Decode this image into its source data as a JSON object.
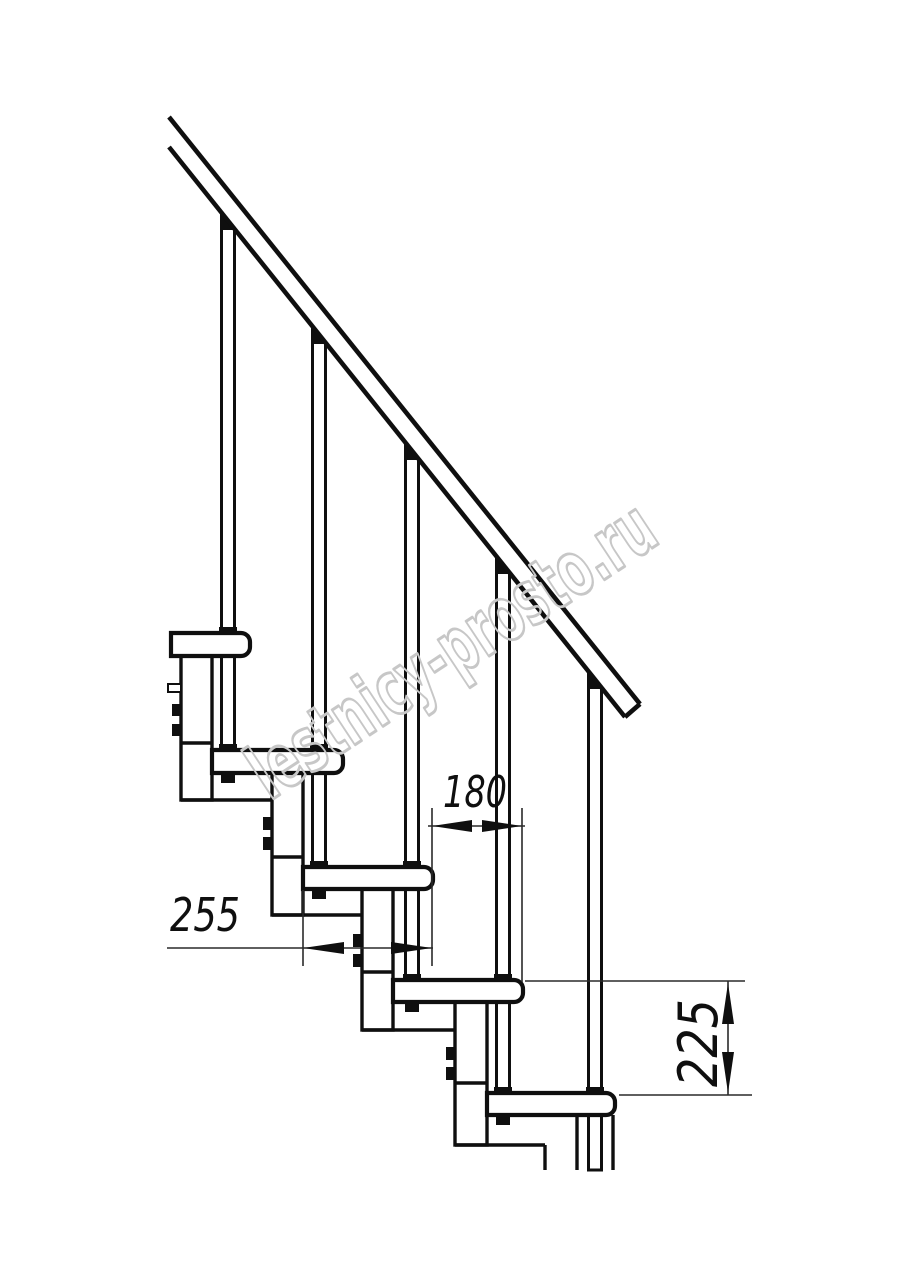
{
  "drawing": {
    "watermark": {
      "text": "lestnicy-prosto.ru",
      "color": "#c7c7c7"
    },
    "dimensions": [
      {
        "id": "step-going",
        "value": "180",
        "orientation": "horizontal"
      },
      {
        "id": "tread-depth",
        "value": "255",
        "orientation": "horizontal"
      },
      {
        "id": "step-rise",
        "value": "225",
        "orientation": "vertical"
      }
    ],
    "colors": {
      "ink": "#0f0f0f",
      "background": "#ffffff"
    }
  }
}
